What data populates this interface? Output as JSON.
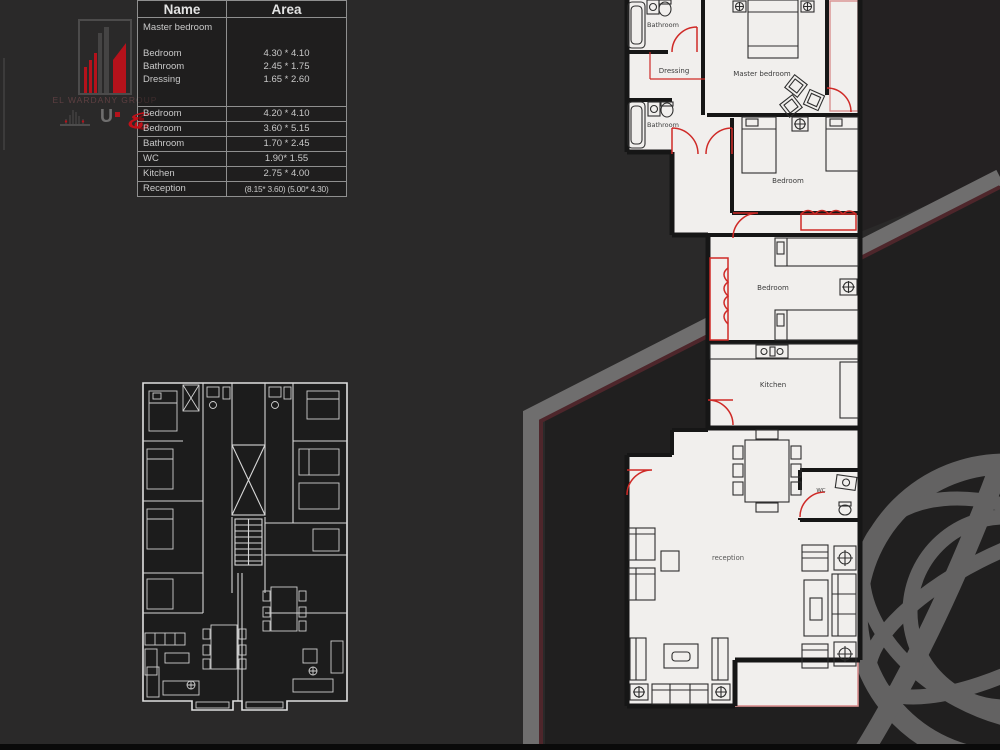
{
  "logo": {
    "company": "EL WARDANY GROUP",
    "mark": "U"
  },
  "table": {
    "headers": {
      "name": "Name",
      "area": "Area"
    },
    "group": {
      "name_lines": [
        "Master bedroom",
        "Bedroom",
        "Bathroom",
        "Dressing"
      ],
      "area_lines": [
        "4.30 * 4.10",
        "2.45 * 1.75",
        "1.65 * 2.60"
      ]
    },
    "rows": [
      {
        "name": "Bedroom",
        "area": "4.20 * 4.10"
      },
      {
        "name": "Bedroom",
        "area": "3.60 * 5.15"
      },
      {
        "name": "Bathroom",
        "area": "1.70 * 2.45"
      },
      {
        "name": "WC",
        "area": "1.90* 1.55"
      },
      {
        "name": "Kitchen",
        "area": "2.75 * 4.00"
      },
      {
        "name": "Reception",
        "area": "(8.15* 3.60) (5.00* 4.30)"
      }
    ]
  },
  "floorplan_labels": {
    "bathroom_top": "Bathroom",
    "dressing": "Dressing",
    "master_bedroom": "Master bedroom",
    "bathroom_lower": "Bathroom",
    "bedroom_upper": "Bedroom",
    "bedroom_lower": "Bedroom",
    "kitchen": "Kitchen",
    "wc": "WC",
    "reception": "reception"
  },
  "colors": {
    "background": "#2a2929",
    "background_dark": "#201f1f",
    "band_gray": "#6f6e6e",
    "band_maroon": "#4e262b",
    "accent_red": "#cf2a27",
    "logo_red": "#b5121b",
    "plan_paper": "#f1efed",
    "plan_wall": "#161616",
    "watermark_gray": "#8d8d8d"
  }
}
